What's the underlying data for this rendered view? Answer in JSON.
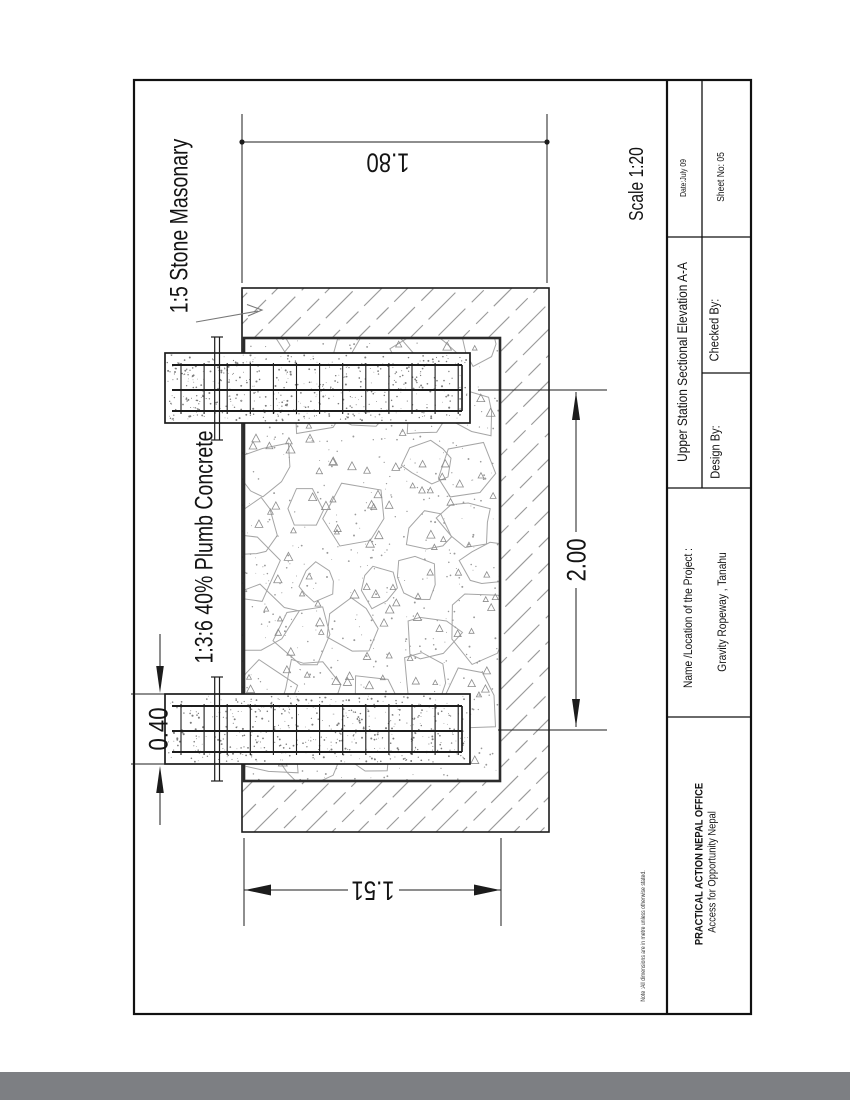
{
  "page": {
    "background": "#ffffff",
    "bottom_bar_color": "#7d7f83"
  },
  "drawing": {
    "scale_label": "Scale 1:20",
    "stone_masonry_label": "1:5 Stone Masonary",
    "plumb_concrete_label": "1:3:6 40%  Plumb Concrete",
    "dim_top_width": "1.80",
    "dim_height": "2.00",
    "dim_band_thickness": "0.40",
    "dim_bottom_width": "1.51"
  },
  "title_block": {
    "date": "Date:July 09",
    "sheet_no": "Sheet No: 05",
    "drawing_title": "Upper Station Sectional Elevation A-A",
    "checked_by": "Checked By:",
    "design_by": "Design By:",
    "project_label": "Name /Location of the Project :",
    "project_value": "Gravity Ropeway ,  Tanahu",
    "org_name": "PRACTICAL ACTION NEPAL OFFICE",
    "org_subtitle": "Access for Opportunity Nepal",
    "note": "Note :All dimensions are in metre unless otherwise stated."
  }
}
